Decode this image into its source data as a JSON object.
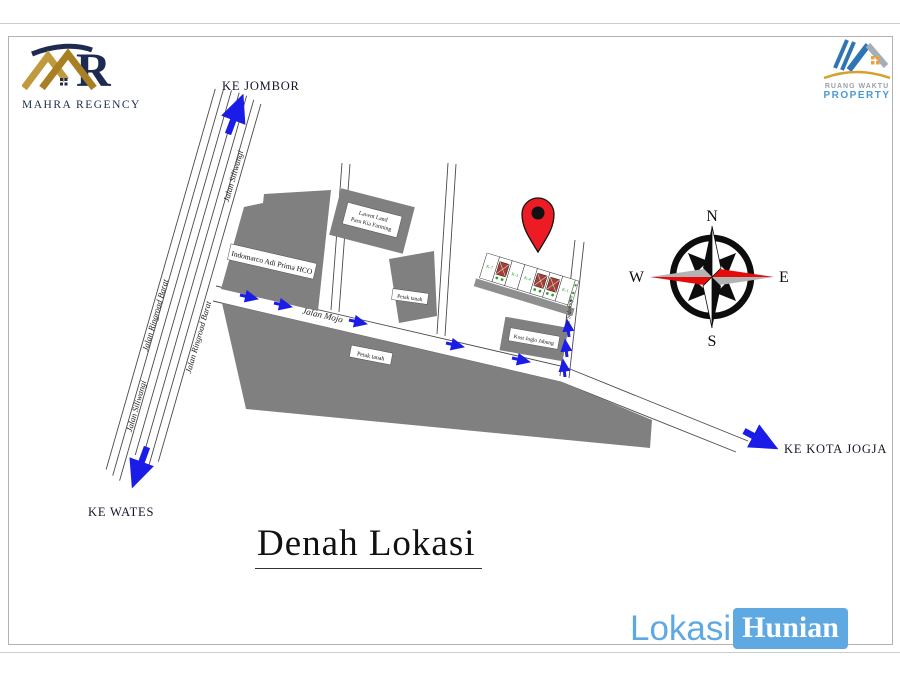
{
  "header": {
    "mahra_logo_text": "MAHRA REGENCY",
    "ruang_waktu_line1": "RUANG WAKTU",
    "ruang_waktu_line2": "PROPERTY"
  },
  "directions": {
    "jombor": "KE JOMBOR",
    "wates": "KE WATES",
    "kota_jogja": "KE KOTA JOGJA"
  },
  "roads": {
    "siliwangi_upper": "Jalan Siliwangi",
    "ringroad_left": "Jalan Ringroad Barat",
    "siliwangi_lower": "Jalan Siliwangi",
    "ringroad_right": "Jalan Ringroad Barat",
    "mojo": "Jalan Mojo",
    "sidomoyo": "Jl. Sidomoyo"
  },
  "buildings": {
    "indomarco": "Indomarco Adi Prima HCO",
    "lavent_line1": "Lavent Land",
    "lavent_line2": "Paru Kia Farming",
    "petak_tall": "Petak tanah",
    "petak_long": "Petak tanah",
    "kost": "Kost Joglo Jabung"
  },
  "site_plan": {
    "plots": [
      "K-7",
      "K-3",
      "K-4",
      "K-1"
    ]
  },
  "compass": {
    "north": "N",
    "south": "S",
    "east": "E",
    "west": "W"
  },
  "title": "Denah Lokasi",
  "footer": {
    "word1": "Lokasi",
    "word2": "Hunian"
  },
  "colors": {
    "arrow_blue": "#1c1ce8",
    "building_gray": "#808080",
    "pin_red": "#ed1c24",
    "footer_blue": "#5fa9e3",
    "logo_gold": "#b8912f",
    "logo_navy": "#1d2b50"
  }
}
